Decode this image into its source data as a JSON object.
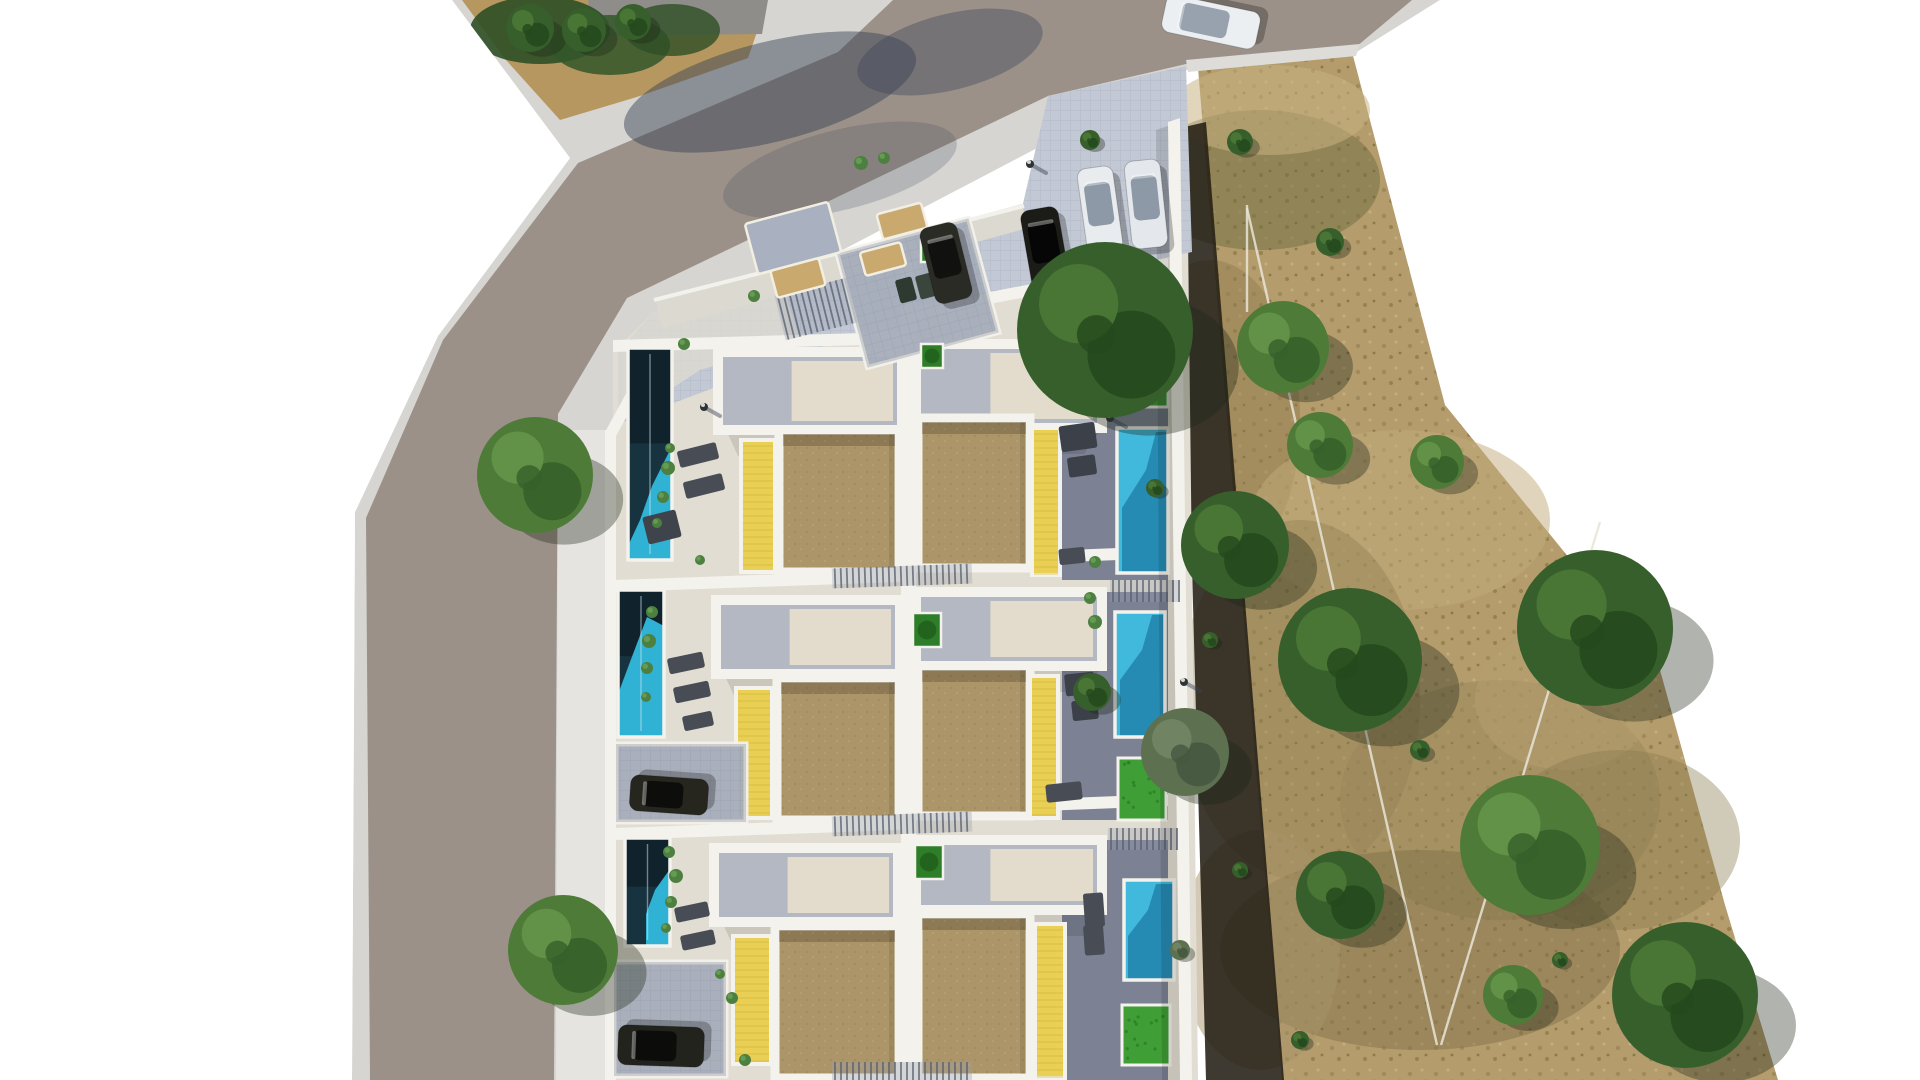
{
  "scene": {
    "description": "Aerial top-down 3D architectural rendering of a residential development: three visible rows of white terraced houses with brown gravel roof terraces, yellow wooden deck strips, turquoise lap pools on the west side and bright cyan pools with lawns on the east side, a diagonal asphalt road with sidewalks wrapping the north-west corner, a parking drive with cars at the top, and a large dry scrubland plot with scattered green trees to the east.",
    "type": "architectural site plan render",
    "time_of_day": "daytime, hard sunlight from north-west"
  },
  "palette": {
    "road": "#9b9189",
    "sidewalk": "#d6d5d1",
    "sidewalk_bright": "#e7e6e2",
    "concrete": "#e2ddd2",
    "walkway": "#dcd9d1",
    "wall": "#f3f2ec",
    "tile": "#c2c8d4",
    "tile_line": "#b1b8c7",
    "roof": "#ac9568",
    "roof_dot": "#a08a5e",
    "deck_yellow": "#e9d055",
    "deck_line": "#c9ad34",
    "pool_dark": "#17333f",
    "pool_teal": "#2fb2d4",
    "pool_bright": "#41b9dc",
    "pool_shade": "#2386ae",
    "grass": "#3f9e35",
    "grass_dark": "#2e7d28",
    "field": "#b49c6c",
    "field_shadow": "#241f15",
    "east_strip": "#7c8294",
    "mat_tan": "#c9a96e",
    "shadow_blue": "#394356",
    "dirt": "#b5975f",
    "gray_bar": "#8f8d89",
    "fence_line": "#e9e5d8",
    "furniture_dark": "#474c55",
    "tree": {
      "dark": [
        "#375f2b",
        "#24491d",
        "#4a7736"
      ],
      "mid": [
        "#4e7c38",
        "#36602a",
        "#629448"
      ],
      "gray": [
        "#5d7050",
        "#465840",
        "#718464"
      ]
    }
  },
  "site": {
    "label": "residential development block",
    "rows_visible": 3,
    "units_visible": 6,
    "pools_visible": 6,
    "cars_parked_driveway": 4,
    "cars_in_carports": 2,
    "cars_on_road": 1,
    "pools": [
      {
        "variant": "left",
        "x": 628,
        "y": 348,
        "w": 44,
        "h": 212,
        "cyan": "628,560 672,560 672,446 652,486 640,520 628,546"
      },
      {
        "variant": "left",
        "x": 618,
        "y": 590,
        "w": 46,
        "h": 147,
        "cyan": "618,737 664,737 664,626 647,617 633,654 618,694"
      },
      {
        "variant": "left",
        "x": 625,
        "y": 838,
        "w": 45,
        "h": 108,
        "cyan": "646,946 670,946 670,869 655,890 646,914"
      },
      {
        "variant": "right",
        "x": 1117,
        "y": 428,
        "w": 51,
        "h": 145,
        "dark": "1168,432 1168,573 1122,573 1122,508 1146,470 1156,432"
      },
      {
        "variant": "right",
        "x": 1115,
        "y": 612,
        "w": 50,
        "h": 125,
        "dark": "1165,615 1165,737 1120,737 1120,680 1142,650 1152,615"
      },
      {
        "variant": "right",
        "x": 1124,
        "y": 880,
        "w": 50,
        "h": 100,
        "dark": "1174,884 1174,980 1128,980 1128,936 1148,910 1156,884"
      }
    ],
    "grass_patches": [
      {
        "x": 1120,
        "y": 302,
        "w": 48,
        "h": 105
      },
      {
        "x": 1118,
        "y": 758,
        "w": 48,
        "h": 62
      },
      {
        "x": 1122,
        "y": 1005,
        "w": 48,
        "h": 60
      }
    ],
    "planters": [
      {
        "x": 921,
        "y": 240,
        "w": 20,
        "h": 22
      },
      {
        "x": 921,
        "y": 344,
        "w": 22,
        "h": 24
      },
      {
        "x": 913,
        "y": 613,
        "w": 28,
        "h": 34
      },
      {
        "x": 915,
        "y": 845,
        "w": 28,
        "h": 34
      }
    ],
    "roofs": [
      [
        779,
        430,
        120,
        142
      ],
      [
        777,
        678,
        122,
        142
      ],
      [
        775,
        926,
        124,
        152
      ],
      [
        918,
        418,
        112,
        150
      ],
      [
        918,
        666,
        112,
        150
      ],
      [
        918,
        914,
        112,
        164
      ]
    ],
    "yellow_decks": [
      [
        741,
        440,
        34,
        132
      ],
      [
        736,
        688,
        36,
        130
      ],
      [
        733,
        936,
        38,
        128
      ],
      [
        1032,
        428,
        28,
        147
      ],
      [
        1030,
        676,
        28,
        142
      ],
      [
        1035,
        924,
        30,
        154
      ]
    ],
    "terraces": [
      [
        718,
        352,
        184,
        78
      ],
      [
        716,
        600,
        184,
        74
      ],
      [
        714,
        848,
        184,
        74
      ],
      [
        916,
        344,
        186,
        84
      ],
      [
        916,
        592,
        186,
        74
      ],
      [
        916,
        840,
        186,
        70
      ]
    ],
    "east_strips": [
      [
        1062,
        344,
        106,
        236
      ],
      [
        1062,
        592,
        106,
        228
      ],
      [
        1062,
        840,
        106,
        240
      ]
    ],
    "carports": [
      [
        850,
        234,
        136,
        118,
        -15
      ],
      [
        616,
        744,
        130,
        78,
        0
      ],
      [
        614,
        962,
        112,
        114,
        0
      ]
    ],
    "slat_bands": [
      [
        779,
        286,
        74,
        46,
        -14
      ],
      [
        1037,
        270,
        64,
        56,
        -14
      ],
      [
        1100,
        272,
        70,
        30,
        0
      ],
      [
        832,
        566,
        140,
        20,
        -2
      ],
      [
        1110,
        580,
        70,
        22,
        0
      ],
      [
        832,
        814,
        140,
        20,
        -2
      ],
      [
        1108,
        828,
        70,
        22,
        0
      ],
      [
        832,
        1062,
        140,
        18,
        0
      ]
    ],
    "mats": [
      {
        "x": 793,
        "y": 238,
        "w": 86,
        "h": 52,
        "a": -15,
        "fill": "#a9b0bf",
        "kind": "crossover"
      },
      {
        "x": 798,
        "y": 278,
        "w": 50,
        "h": 28,
        "a": -15,
        "kind": "doormat"
      },
      {
        "x": 883,
        "y": 259,
        "w": 42,
        "h": 24,
        "a": -15,
        "kind": "doormat"
      },
      {
        "x": 902,
        "y": 221,
        "w": 46,
        "h": 26,
        "a": -15,
        "kind": "doormat"
      }
    ],
    "furniture": [
      [
        906,
        290,
        17,
        24,
        -15,
        "#2e3930"
      ],
      [
        926,
        286,
        17,
        24,
        -15,
        "#3a453b"
      ],
      [
        698,
        455,
        40,
        17,
        -14
      ],
      [
        704,
        486,
        40,
        17,
        -14
      ],
      [
        662,
        527,
        34,
        28,
        -14,
        "#3f444c"
      ],
      [
        686,
        663,
        36,
        16,
        -12
      ],
      [
        692,
        692,
        36,
        16,
        -12
      ],
      [
        698,
        721,
        30,
        15,
        -12
      ],
      [
        692,
        912,
        34,
        15,
        -12
      ],
      [
        698,
        940,
        34,
        15,
        -12
      ],
      [
        1078,
        437,
        36,
        26,
        -8,
        "#3b4049"
      ],
      [
        1082,
        466,
        28,
        20,
        -8,
        "#3b4049"
      ],
      [
        1072,
        556,
        26,
        16,
        -6
      ],
      [
        1122,
        355,
        17,
        42,
        3,
        "#c2a169"
      ],
      [
        1147,
        355,
        17,
        42,
        3,
        "#b89a63"
      ],
      [
        1080,
        684,
        30,
        22,
        -6,
        "#3b4049"
      ],
      [
        1085,
        710,
        26,
        20,
        -6,
        "#3b4049"
      ],
      [
        1064,
        792,
        36,
        18,
        -6
      ],
      [
        1094,
        910,
        20,
        34,
        -4
      ],
      [
        1094,
        940,
        20,
        30,
        -4
      ]
    ],
    "plants": [
      [
        668,
        468,
        7
      ],
      [
        663,
        497,
        6
      ],
      [
        657,
        523,
        5
      ],
      [
        670,
        448,
        5
      ],
      [
        652,
        612,
        6
      ],
      [
        649,
        641,
        7
      ],
      [
        647,
        668,
        6
      ],
      [
        646,
        697,
        5
      ],
      [
        669,
        852,
        6
      ],
      [
        676,
        876,
        7
      ],
      [
        671,
        902,
        6
      ],
      [
        666,
        928,
        5
      ],
      [
        861,
        163,
        7
      ],
      [
        884,
        158,
        6
      ],
      [
        754,
        296,
        6
      ],
      [
        684,
        344,
        6
      ],
      [
        1090,
        598,
        6
      ],
      [
        1095,
        622,
        7
      ],
      [
        732,
        998,
        6
      ],
      [
        720,
        974,
        5
      ],
      [
        1095,
        562,
        6
      ],
      [
        700,
        560,
        5
      ],
      [
        745,
        1060,
        6
      ]
    ]
  },
  "people": [
    [
      1030,
      164
    ],
    [
      704,
      407
    ],
    [
      1110,
      418
    ],
    [
      1184,
      682
    ]
  ],
  "vehicles": [
    {
      "x": 946,
      "y": 263,
      "w": 38,
      "h": 78,
      "a": -14,
      "c": "#2b2b26",
      "g": "#11110f"
    },
    {
      "x": 1045,
      "y": 248,
      "w": 38,
      "h": 80,
      "a": -10,
      "c": "#1b1b18",
      "g": "#060606"
    },
    {
      "x": 1100,
      "y": 210,
      "w": 36,
      "h": 86,
      "a": -8,
      "c": "#e9ecef",
      "g": "#8d99a6"
    },
    {
      "x": 1146,
      "y": 204,
      "w": 36,
      "h": 88,
      "a": -6,
      "c": "#e4e8ec",
      "g": "#8d99a6"
    },
    {
      "x": 1211,
      "y": 22,
      "w": 38,
      "h": 96,
      "a": -78,
      "c": "#eceff2",
      "g": "#97a2ae"
    },
    {
      "x": 669,
      "y": 795,
      "w": 36,
      "h": 78,
      "a": -86,
      "c": "#26261f",
      "g": "#0d0d0b"
    },
    {
      "x": 661,
      "y": 1046,
      "w": 40,
      "h": 86,
      "a": -88,
      "c": "#23231e",
      "g": "#0c0c0a"
    }
  ],
  "trees": [
    {
      "x": 535,
      "y": 475,
      "r": 58,
      "t": "mid",
      "l": "site"
    },
    {
      "x": 563,
      "y": 950,
      "r": 55,
      "t": "mid",
      "l": "site"
    },
    {
      "x": 530,
      "y": 28,
      "r": 24,
      "t": "dark",
      "l": "hedge"
    },
    {
      "x": 584,
      "y": 30,
      "r": 22,
      "t": "dark",
      "l": "hedge"
    },
    {
      "x": 633,
      "y": 22,
      "r": 18,
      "t": "dark",
      "l": "hedge"
    },
    {
      "x": 1105,
      "y": 330,
      "r": 88,
      "t": "dark",
      "l": "field"
    },
    {
      "x": 1240,
      "y": 142,
      "r": 13,
      "t": "dark",
      "l": "field"
    },
    {
      "x": 1330,
      "y": 242,
      "r": 14,
      "t": "dark",
      "l": "field"
    },
    {
      "x": 1090,
      "y": 140,
      "r": 10,
      "t": "dark",
      "l": "field"
    },
    {
      "x": 1283,
      "y": 347,
      "r": 46,
      "t": "mid",
      "l": "field"
    },
    {
      "x": 1235,
      "y": 545,
      "r": 54,
      "t": "dark",
      "l": "field"
    },
    {
      "x": 1320,
      "y": 445,
      "r": 33,
      "t": "mid",
      "l": "field"
    },
    {
      "x": 1185,
      "y": 752,
      "r": 44,
      "t": "gray",
      "l": "field"
    },
    {
      "x": 1092,
      "y": 692,
      "r": 19,
      "t": "dark",
      "l": "field"
    },
    {
      "x": 1350,
      "y": 660,
      "r": 72,
      "t": "dark",
      "l": "field"
    },
    {
      "x": 1595,
      "y": 628,
      "r": 78,
      "t": "dark",
      "l": "field"
    },
    {
      "x": 1530,
      "y": 845,
      "r": 70,
      "t": "mid",
      "l": "field"
    },
    {
      "x": 1685,
      "y": 995,
      "r": 73,
      "t": "dark",
      "l": "field"
    },
    {
      "x": 1340,
      "y": 895,
      "r": 44,
      "t": "dark",
      "l": "field"
    },
    {
      "x": 1513,
      "y": 995,
      "r": 30,
      "t": "mid",
      "l": "field"
    },
    {
      "x": 1437,
      "y": 462,
      "r": 27,
      "t": "mid",
      "l": "field"
    },
    {
      "x": 1155,
      "y": 488,
      "r": 9,
      "t": "dark",
      "l": "field"
    },
    {
      "x": 1210,
      "y": 640,
      "r": 8,
      "t": "dark",
      "l": "field"
    },
    {
      "x": 1420,
      "y": 750,
      "r": 10,
      "t": "dark",
      "l": "field"
    },
    {
      "x": 1300,
      "y": 1040,
      "r": 9,
      "t": "dark",
      "l": "field"
    },
    {
      "x": 1560,
      "y": 960,
      "r": 8,
      "t": "dark",
      "l": "field"
    },
    {
      "x": 1180,
      "y": 950,
      "r": 10,
      "t": "gray",
      "l": "field"
    },
    {
      "x": 1240,
      "y": 870,
      "r": 8,
      "t": "dark",
      "l": "field"
    }
  ],
  "field": {
    "patches": [
      [
        1260,
        180,
        120,
        70,
        "#6e6b3f",
        0.5
      ],
      [
        1270,
        110,
        100,
        45,
        "#c8b283",
        0.55
      ],
      [
        1210,
        420,
        90,
        160,
        "#8d7c50",
        0.45
      ],
      [
        1400,
        520,
        150,
        90,
        "#c2ab7a",
        0.5
      ],
      [
        1300,
        700,
        120,
        180,
        "#8d7c50",
        0.4
      ],
      [
        1500,
        800,
        160,
        120,
        "#97855a",
        0.5
      ],
      [
        1420,
        950,
        200,
        100,
        "#7d6f46",
        0.45
      ],
      [
        1260,
        950,
        80,
        120,
        "#a8946a",
        0.5
      ],
      [
        1565,
        700,
        90,
        70,
        "#b5a06f",
        0.5
      ],
      [
        1620,
        840,
        120,
        90,
        "#8a7a4e",
        0.4
      ]
    ],
    "fence_lines": [
      [
        1247,
        205,
        1247,
        312
      ],
      [
        1247,
        208,
        1437,
        1045
      ],
      [
        1600,
        522,
        1441,
        1045
      ]
    ]
  }
}
